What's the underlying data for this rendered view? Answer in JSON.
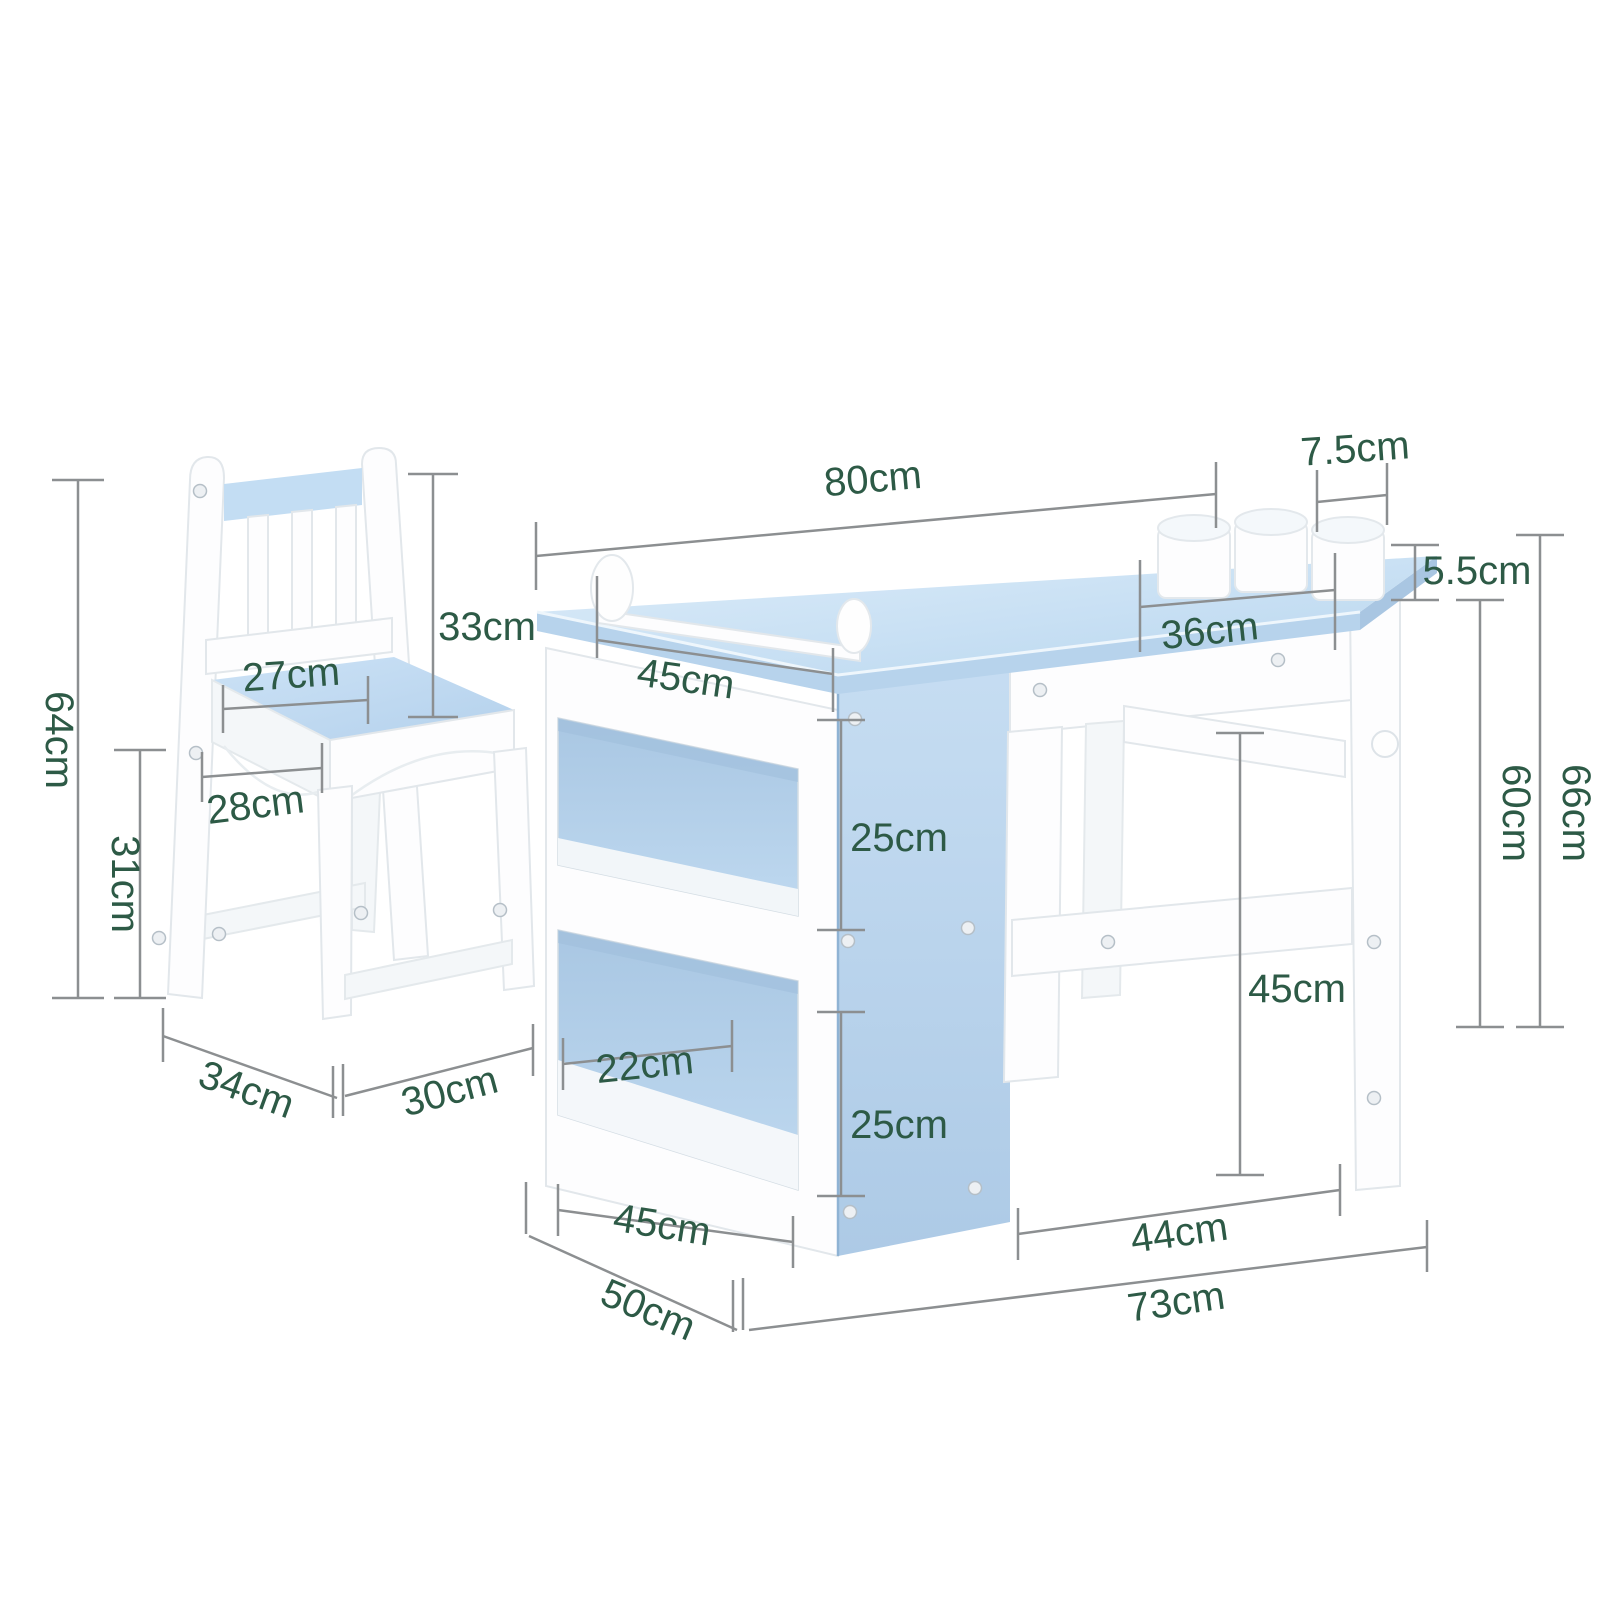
{
  "figure": {
    "kind": "product-dimension-diagram",
    "subject": "kids desk with storage shelves, paper-roll holder, three cups and a matching chair",
    "background": "#ffffff"
  },
  "colors": {
    "label_green": "#2d5a46",
    "dimension_line_gray": "#8c8f91",
    "furniture_blue": "#bdd8f0",
    "furniture_blue_dark": "#a9c6e2",
    "furniture_white": "#fdfdfe"
  },
  "dims": {
    "desk_top_width": {
      "text": "80cm"
    },
    "cup_diameter": {
      "text": "7.5cm"
    },
    "cup_height": {
      "text": "5.5cm"
    },
    "cup_shelf_depth": {
      "text": "36cm"
    },
    "paper_roll_width": {
      "text": "45cm"
    },
    "chair_backrest_height": {
      "text": "33cm"
    },
    "chair_back_width": {
      "text": "27cm"
    },
    "chair_total_height": {
      "text": "64cm"
    },
    "chair_seat_depth": {
      "text": "28cm"
    },
    "chair_seat_height": {
      "text": "31cm"
    },
    "chair_footprint_depth": {
      "text": "34cm"
    },
    "chair_footprint_width": {
      "text": "30cm"
    },
    "shelf_upper_cubby_height": {
      "text": "25cm"
    },
    "shelf_cubby_inner_width": {
      "text": "22cm"
    },
    "shelf_lower_cubby_height": {
      "text": "25cm"
    },
    "shelf_bottom_width": {
      "text": "45cm"
    },
    "shelf_depth": {
      "text": "50cm"
    },
    "desk_leg_clearance_height": {
      "text": "45cm"
    },
    "desk_leg_span": {
      "text": "44cm"
    },
    "desk_base_width": {
      "text": "73cm"
    },
    "desk_surface_height": {
      "text": "60cm"
    },
    "desk_total_height": {
      "text": "66cm"
    }
  }
}
